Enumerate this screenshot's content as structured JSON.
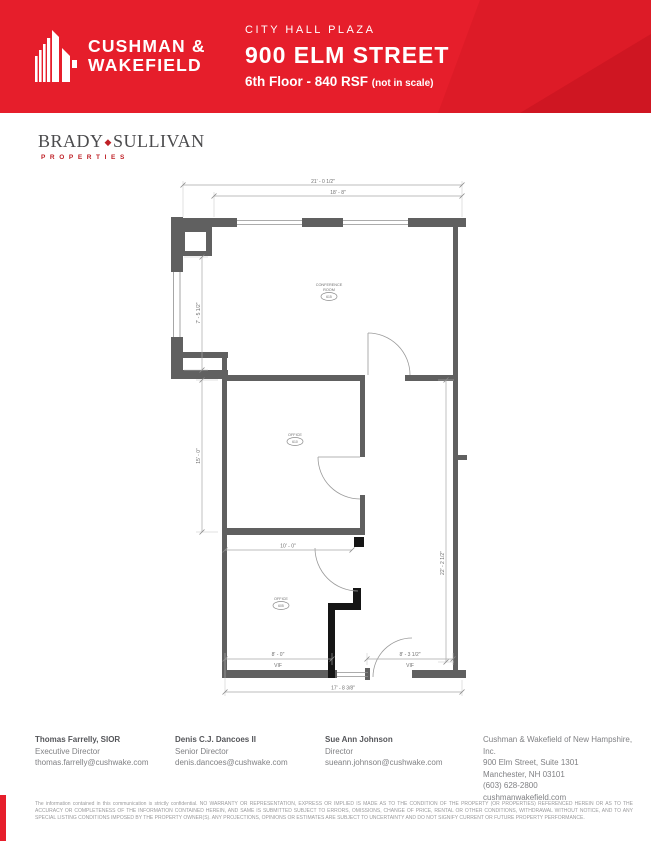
{
  "colors": {
    "header_red": "#e61e2b",
    "header_shade": "#d41925",
    "brady_red": "#bf2026",
    "wall_gray": "#606060",
    "demising_black": "#151515"
  },
  "header": {
    "brand_line1": "CUSHMAN &",
    "brand_line2": "WAKEFIELD",
    "property_name": "CITY HALL PLAZA",
    "address": "900 ELM STREET",
    "floor_info": "6th Floor - 840 RSF",
    "scale_note": "(not in scale)"
  },
  "landlord_logo": {
    "name_left": "BRADY",
    "diamond": "◆",
    "name_right": "SULLIVAN",
    "subtitle": "PROPERTIES"
  },
  "floor_plan": {
    "dimensions": {
      "overall_width_top": "21' - 0 1/2\"",
      "window_band_top": "18' - 8\"",
      "left_upper": "7' - 5 1/2\"",
      "left_lower": "15' - 0\"",
      "right_side": "22' - 2 1/2\"",
      "room_width": "10' - 0\"",
      "bottom_left": "8' - 0\"",
      "bottom_left_note": "VIF",
      "bottom_right": "8' - 3 1/2\"",
      "bottom_right_note": "VIF",
      "overall_width_bottom": "17' - 8 3/8\""
    },
    "room_tags": [
      {
        "name_line1": "CONFERENCE",
        "name_line2": "ROOM",
        "number": "615"
      },
      {
        "name_line1": "OFFICE",
        "name_line2": "",
        "number": "610"
      },
      {
        "name_line1": "OFFICE",
        "name_line2": "",
        "number": "605"
      }
    ]
  },
  "contacts": [
    {
      "name": "Thomas Farrelly, SIOR",
      "title": "Executive Director",
      "email": "thomas.farrelly@cushwake.com"
    },
    {
      "name": "Denis C.J. Dancoes II",
      "title": "Senior Director",
      "email": "denis.dancoes@cushwake.com"
    },
    {
      "name": "Sue Ann Johnson",
      "title": "Director",
      "email": "sueann.johnson@cushwake.com"
    }
  ],
  "company": {
    "name": "Cushman & Wakefield of New Hampshire, Inc.",
    "address1": "900 Elm Street, Suite 1301",
    "address2": "Manchester, NH 03101",
    "phone": "(603) 628-2800",
    "website": "cushmanwakefield.com"
  },
  "disclaimer": "The information contained in this communication is strictly confidential. NO WARRANTY OR REPRESENTATION, EXPRESS OR IMPLIED IS MADE AS TO THE CONDITION OF THE PROPERTY (OR PROPERTIES) REFERENCED HEREIN OR AS TO THE ACCURACY OR COMPLETENESS OF THE INFORMATION CONTAINED HEREIN, AND SAME IS SUBMITTED SUBJECT TO ERRORS, OMISSIONS, CHANGE OF PRICE, RENTAL OR OTHER CONDITIONS, WITHDRAWAL WITHOUT NOTICE, AND TO ANY SPECIAL LISTING CONDITIONS IMPOSED BY THE PROPERTY OWNER(S).  ANY PROJECTIONS, OPINIONS OR ESTIMATES ARE SUBJECT TO UNCERTAINTY AND DO NOT SIGNIFY CURRENT OR FUTURE PROPERTY PERFORMANCE."
}
